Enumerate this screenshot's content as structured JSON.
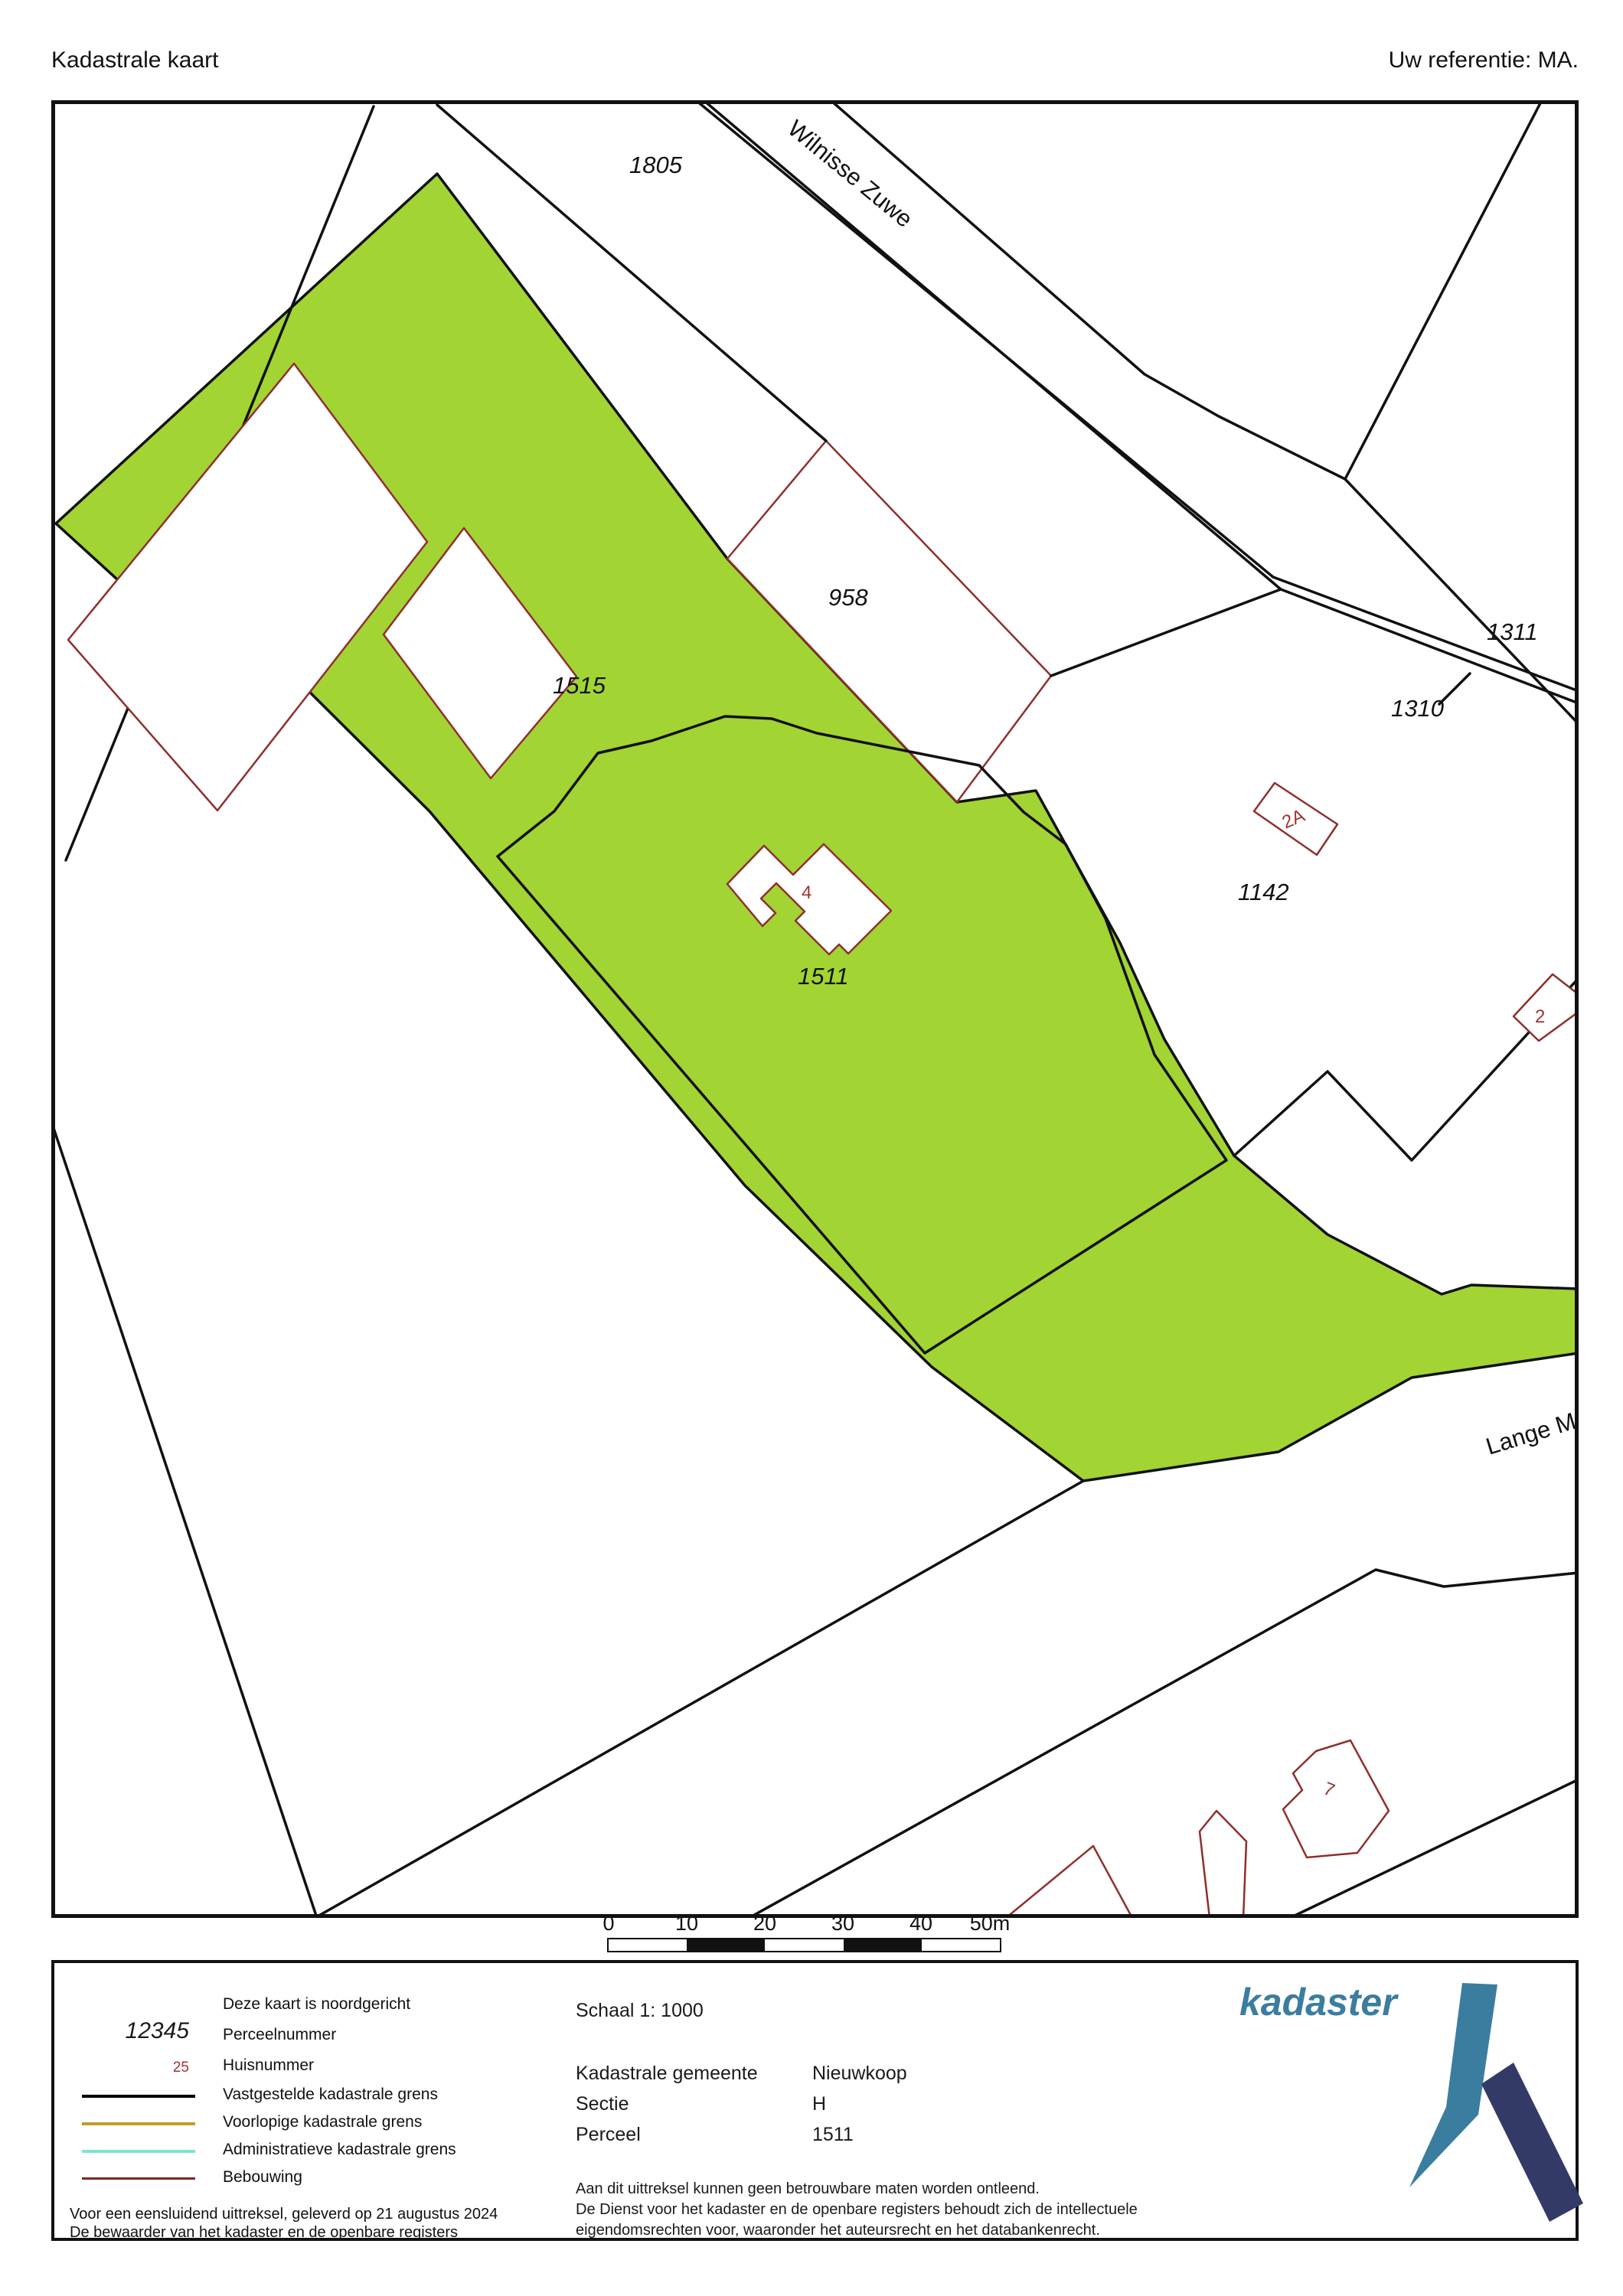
{
  "header": {
    "title": "Kadastrale kaart",
    "reference": "Uw referentie: MA."
  },
  "map": {
    "highlight_color": "#a2d433",
    "roads": {
      "wilnisse_zuwe": "Wilnisse Zuwe",
      "lange_m": "Lange M"
    },
    "parcels": {
      "p1805": "1805",
      "p958": "958",
      "p1515": "1515",
      "p1311": "1311",
      "p1310": "1310",
      "p1142": "1142",
      "p1511": "1511"
    },
    "houses": {
      "h4": "4",
      "h2a": "2A",
      "h2": "2",
      "h7": "7"
    }
  },
  "scale_bar": {
    "ticks": [
      "0",
      "10",
      "20",
      "30",
      "40",
      "50m"
    ]
  },
  "legend": {
    "north_note": "Deze kaart is noordgericht",
    "perceelnummer_symbol": "12345",
    "perceelnummer_label": "Perceelnummer",
    "huisnummer_symbol": "25",
    "huisnummer_label": "Huisnummer",
    "grens_vastgesteld": "Vastgestelde kadastrale grens",
    "grens_voorlopig": "Voorlopige kadastrale grens",
    "grens_administratief": "Administratieve kadastrale grens",
    "bebouwing": "Bebouwing",
    "colors": {
      "vastgesteld": "#000000",
      "voorlopig": "#c09c28",
      "administratief": "#7de4d2",
      "bebouwing": "#7b2927"
    },
    "footer_line1": "Voor een eensluidend uittreksel, geleverd op 21 augustus 2024",
    "footer_line2": "De bewaarder van het kadaster en de openbare registers",
    "schaal": "Schaal 1: 1000",
    "gemeente_label": "Kadastrale gemeente",
    "gemeente_value": "Nieuwkoop",
    "sectie_label": "Sectie",
    "sectie_value": "H",
    "perceel_label": "Perceel",
    "perceel_value": "1511",
    "disclaimer_line1": "Aan dit uittreksel kunnen geen betrouwbare maten worden ontleend.",
    "disclaimer_line2": "De Dienst voor het kadaster en de openbare registers behoudt zich de intellectuele",
    "disclaimer_line3": "eigendomsrechten voor, waaronder het auteursrecht en het databankenrecht.",
    "logo_text": "kadaster"
  }
}
